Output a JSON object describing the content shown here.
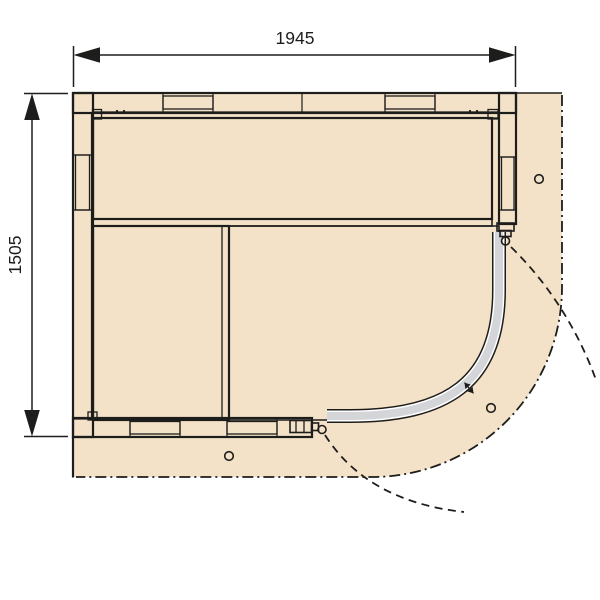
{
  "dimensions": {
    "width": "1945",
    "height": "1505"
  },
  "palette": {
    "outline": "#1d1d1b",
    "room_fill": "#f4e2c8",
    "wall_fill": "#e9c79b",
    "wood_light": "#f6e9c1",
    "wood_mid": "#edd2a4",
    "glass_gray": "#d3d5d8",
    "floor_gray": "#c9cdd2",
    "hatch_bg": "#f3f3f0"
  },
  "features": {
    "vent_holes": 3,
    "door_pivots": 2,
    "door_handles": 1,
    "wall_hatch_blocks": 6,
    "door_swing_arcs": 2
  }
}
